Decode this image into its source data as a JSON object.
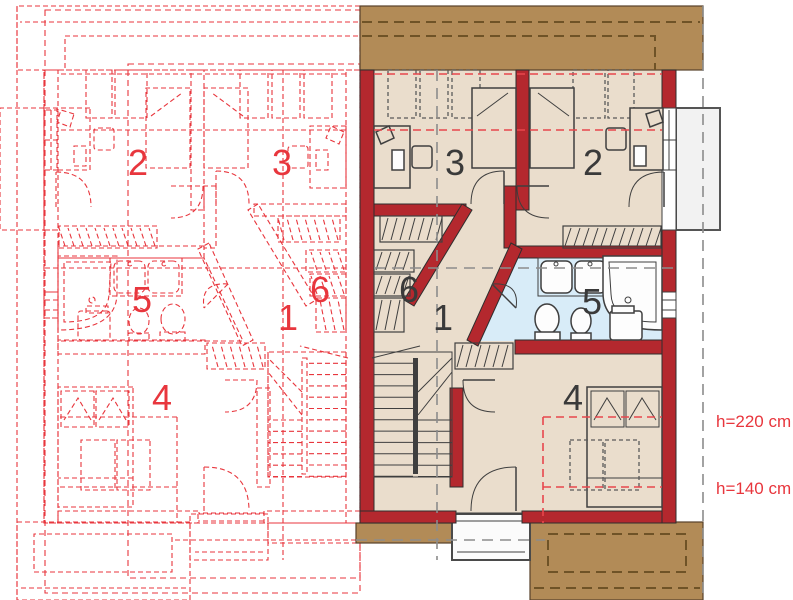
{
  "title": "attic floor plan",
  "colors": {
    "wall": "#b4282e",
    "floor": "#eaddcc",
    "bathroom_floor": "#d8ecf8",
    "roof": "#b28b57",
    "roof_line": "#6f5327",
    "plan_red": "#e8363d",
    "dash_red": "#e8474d",
    "label_dark": "#3a3a3a",
    "dash_gray": "#8c8c8c",
    "balcony": "#f2f2f2"
  },
  "labels": {
    "right": [
      {
        "text": "3",
        "x": 445,
        "y": 175
      },
      {
        "text": "2",
        "x": 583,
        "y": 175
      },
      {
        "text": "6",
        "x": 399,
        "y": 302
      },
      {
        "text": "1",
        "x": 433,
        "y": 330
      },
      {
        "text": "5",
        "x": 582,
        "y": 314
      },
      {
        "text": "4",
        "x": 563,
        "y": 410
      }
    ],
    "left": [
      {
        "text": "2",
        "x": 128,
        "y": 175
      },
      {
        "text": "3",
        "x": 272,
        "y": 175
      },
      {
        "text": "5",
        "x": 132,
        "y": 312
      },
      {
        "text": "6",
        "x": 310,
        "y": 302
      },
      {
        "text": "1",
        "x": 278,
        "y": 330
      },
      {
        "text": "4",
        "x": 152,
        "y": 410
      }
    ]
  },
  "annotations": [
    {
      "text": "h=220 cm",
      "x": 716,
      "y": 427
    },
    {
      "text": "h=140 cm",
      "x": 716,
      "y": 494
    }
  ]
}
